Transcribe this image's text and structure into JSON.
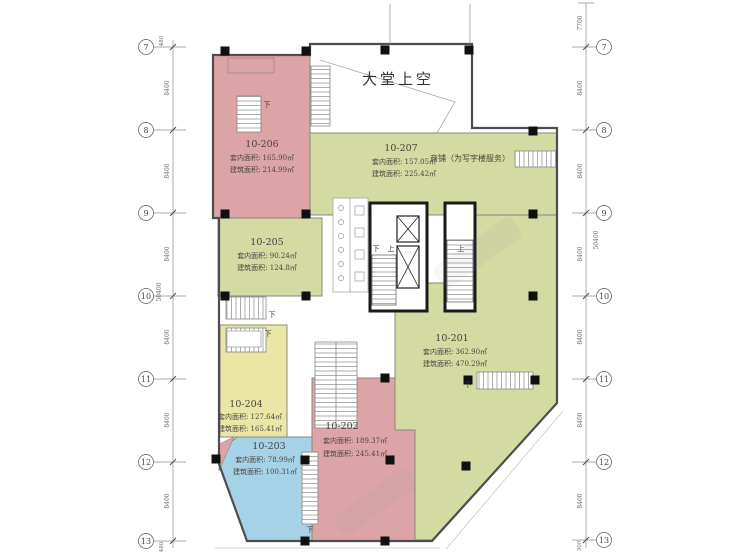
{
  "plan": {
    "lobby_label": "大堂上空",
    "shop_note": "商铺（为写字楼服务）",
    "down": "下",
    "up": "上",
    "units": {
      "u201": {
        "id": "10-201",
        "inner": "套内面积: 362.90㎡",
        "gross": "建筑面积: 470.29㎡"
      },
      "u202": {
        "id": "10-202",
        "inner": "套内面积: 189.37㎡",
        "gross": "建筑面积: 245.41㎡"
      },
      "u203": {
        "id": "10-203",
        "inner": "套内面积: 78.99㎡",
        "gross": "建筑面积: 100.31㎡"
      },
      "u204": {
        "id": "10-204",
        "inner": "套内面积: 127.64㎡",
        "gross": "建筑面积: 165.41㎡"
      },
      "u205": {
        "id": "10-205",
        "inner": "套内面积: 90.24㎡",
        "gross": "建筑面积: 124.8㎡"
      },
      "u206": {
        "id": "10-206",
        "inner": "套内面积: 165.90㎡",
        "gross": "建筑面积: 214.99㎡"
      },
      "u207": {
        "id": "10-207",
        "inner": "套内面积: 157.05㎡",
        "gross": "建筑面积: 225.42㎡"
      }
    }
  },
  "grid": {
    "rows": [
      "7",
      "8",
      "9",
      "10",
      "11",
      "12",
      "13"
    ],
    "bay": "8400",
    "top_right": "7700",
    "total_left": "50400",
    "total_right": "50400",
    "edge_top_left": "480",
    "edge_bottom_left": "480",
    "edge_bottom_right": "300"
  },
  "colors": {
    "pink": "#dca4a6",
    "green": "#d3daa2",
    "yellow": "#eae6a6",
    "blue": "#a6d2e8"
  }
}
